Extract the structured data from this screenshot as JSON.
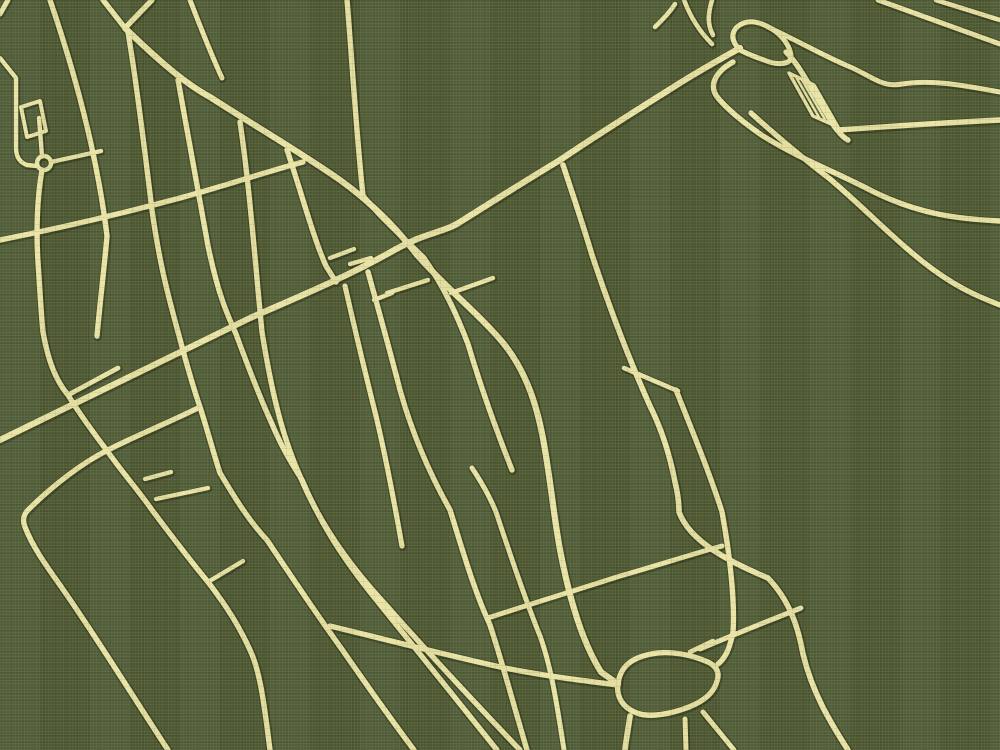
{
  "canvas": {
    "width": 1000,
    "height": 750
  },
  "style": {
    "background": "#4f5b33",
    "road_fill": "#e9e3a2",
    "road_casing": "#353f20",
    "casing_extra": 3,
    "hatch_width": 2.4
  },
  "map": {
    "kind": "minimalist-street-map-poster",
    "features": {
      "roundabout": {
        "cx": 44,
        "cy": 163,
        "r": 7
      },
      "pond_ring_road": {
        "cx": 667,
        "cy": 684
      },
      "bridge_hatch": {
        "x": 813,
        "y": 100
      },
      "interchange_loop": {
        "cx": 762,
        "cy": 43
      }
    }
  },
  "roads": [
    {
      "id": "v2-avenue",
      "w": 6.2,
      "casing": true,
      "d": "M0,440 C90,396 180,352 250,318 C300,296 345,278 398,248 C425,233 445,232 460,222 C495,200 530,178 560,160 C600,133 640,108 672,88 C700,70 726,56 740,48"
    },
    {
      "id": "v1-avenue",
      "w": 6.2,
      "casing": true,
      "d": "M125,28 C160,62 186,84 210,97 C255,126 300,152 340,180 C372,203 398,230 417,255 C448,290 480,315 504,344 C528,374 538,410 544,444 C552,490 554,520 561,555 C571,606 584,645 601,672 L618,684"
    },
    {
      "id": "v-arm-left",
      "w": 5.4,
      "casing": true,
      "d": "M103,0 L125,28"
    },
    {
      "id": "v-arm-right",
      "w": 5.4,
      "casing": true,
      "d": "M152,0 L125,28"
    },
    {
      "id": "x1-cross",
      "w": 5.4,
      "casing": true,
      "d": "M0,240 C60,228 120,214 180,198 C225,186 265,172 303,162"
    },
    {
      "id": "corner-nw",
      "w": 5.0,
      "casing": true,
      "d": "M8,0 L0,14"
    },
    {
      "id": "w2-street",
      "w": 5.4,
      "casing": true,
      "d": "M50,0 C78,82 98,162 107,236 C104,270 100,302 97,336"
    },
    {
      "id": "complex-l",
      "w": 4.4,
      "casing": true,
      "d": "M0,58 L16,78 L16,148 Q16,161 27,165 L37,166"
    },
    {
      "id": "complex-block",
      "w": 4.0,
      "casing": true,
      "d": "M21,107 L40,101 L46,131 L27,137 Z"
    },
    {
      "id": "roundabout",
      "w": 4.4,
      "casing": true,
      "d": "M37,163 a7,7 0 1 0 14,0 a7,7 0 1 0 -14,0"
    },
    {
      "id": "stub-up",
      "w": 4.4,
      "casing": true,
      "d": "M42,156 L39,118"
    },
    {
      "id": "stub-right",
      "w": 4.4,
      "casing": true,
      "d": "M51,162 L101,151"
    },
    {
      "id": "w1-street",
      "w": 5.4,
      "casing": true,
      "d": "M42,170 C37,198 36,232 38,262 C40,292 41,312 43,332 C49,366 58,383 68,395 C82,418 96,436 108,452 C122,472 138,490 152,510 C170,534 189,559 208,582 C228,608 240,628 250,650 C261,673 265,712 270,750"
    },
    {
      "id": "spur-ra",
      "w": 4.8,
      "casing": true,
      "d": "M68,395 L118,368"
    },
    {
      "id": "g3-street",
      "w": 5.4,
      "casing": true,
      "d": "M128,32 C138,92 146,162 152,210 C160,268 170,302 178,332 C186,362 194,390 200,407 C208,432 214,455 220,473 C236,500 250,522 267,540 C291,576 315,612 341,648 C366,684 390,718 414,750"
    },
    {
      "id": "ca-road",
      "w": 5.4,
      "casing": true,
      "d": "M200,407 C170,422 135,436 108,450 C80,464 50,488 28,510 C24,514 22,520 25,527 C33,548 48,568 62,588 C95,635 132,695 168,750"
    },
    {
      "id": "g4-street",
      "w": 5.4,
      "casing": true,
      "d": "M178,80 C188,136 199,194 208,246 C218,294 227,314 236,334 C250,372 260,398 272,424 C282,448 292,464 302,480 C320,522 340,554 370,592 C402,632 452,694 497,750"
    },
    {
      "id": "g5-street",
      "w": 5.4,
      "casing": true,
      "d": "M240,122 C250,190 255,262 262,332 C272,395 283,438 300,476 C318,520 346,562 386,605 C424,648 478,706 520,750"
    },
    {
      "id": "spur-t1",
      "w": 4.4,
      "casing": true,
      "d": "M145,479 L171,472"
    },
    {
      "id": "spur-t2",
      "w": 4.4,
      "casing": true,
      "d": "M156,499 L208,488"
    },
    {
      "id": "spur-w1",
      "w": 4.4,
      "casing": true,
      "d": "M208,582 L243,561"
    },
    {
      "id": "short-top",
      "w": 5.0,
      "casing": true,
      "d": "M190,0 C200,26 210,52 222,78"
    },
    {
      "id": "w8-street",
      "w": 5.4,
      "casing": true,
      "d": "M287,150 C300,188 314,240 326,266 L336,282"
    },
    {
      "id": "b-street",
      "w": 5.4,
      "casing": true,
      "d": "M347,0 C352,60 356,130 363,196"
    },
    {
      "id": "w7-street",
      "w": 5.4,
      "casing": true,
      "d": "M363,196 C385,222 408,242 424,258 C446,290 458,318 468,344 C481,388 497,432 512,470"
    },
    {
      "id": "w6-street",
      "w": 5.4,
      "casing": true,
      "d": "M368,272 C380,315 391,355 400,390 C414,440 432,478 450,510 C462,548 473,588 490,625 C504,668 515,710 527,750"
    },
    {
      "id": "g6-street",
      "w": 5.2,
      "casing": true,
      "d": "M345,286 C355,330 365,372 374,408 C382,440 390,478 402,546"
    },
    {
      "id": "rung-r3",
      "w": 4.4,
      "casing": true,
      "d": "M387,293 L428,280"
    },
    {
      "id": "rung-rb",
      "w": 4.4,
      "casing": true,
      "d": "M451,293 L493,278"
    },
    {
      "id": "rung-rd",
      "w": 4.4,
      "casing": true,
      "d": "M330,258 L354,249"
    },
    {
      "id": "rung-re",
      "w": 4.4,
      "casing": true,
      "d": "M350,264 L371,258"
    },
    {
      "id": "rung-rf",
      "w": 4.4,
      "casing": true,
      "d": "M374,300 L392,293"
    },
    {
      "id": "g9-street",
      "w": 5.6,
      "casing": true,
      "d": "M563,165 C573,195 583,225 592,255 C611,312 632,366 650,406 C662,430 670,456 675,482 C678,494 679,502 679,512 C690,542 730,562 768,578 C789,600 798,626 803,654 C812,692 830,722 848,750"
    },
    {
      "id": "g10-street",
      "w": 5.4,
      "casing": true,
      "d": "M676,390 C696,440 712,480 722,512 C730,555 735,602 733,632 C729,652 724,659 718,664"
    },
    {
      "id": "rung-rc",
      "w": 4.6,
      "casing": true,
      "d": "M624,368 L678,391"
    },
    {
      "id": "x2-avenue",
      "w": 5.4,
      "casing": true,
      "d": "M330,626 C392,641 450,656 505,668 C545,676 586,681 618,685"
    },
    {
      "id": "x3-cross",
      "w": 5.0,
      "casing": true,
      "d": "M488,618 C530,604 580,589 620,576 C656,566 692,554 722,546"
    },
    {
      "id": "x4-cross",
      "w": 5.0,
      "casing": true,
      "d": "M700,649 C735,634 768,621 801,608"
    },
    {
      "id": "pond-loop",
      "w": 5.4,
      "casing": true,
      "d": "M618,684 C620,667 631,658 651,654 C670,650 692,655 708,662 C716,666 720,672 717,681 C714,693 704,701 689,707 C671,714 649,718 637,713 C623,708 616,697 618,684 Z"
    },
    {
      "id": "pond-stub-ne",
      "w": 4.6,
      "casing": true,
      "d": "M690,652 L713,641"
    },
    {
      "id": "pond-stub-s1",
      "w": 5.0,
      "casing": true,
      "d": "M685,719 L686,750"
    },
    {
      "id": "pond-stub-s2",
      "w": 5.0,
      "casing": true,
      "d": "M703,712 C716,728 726,740 734,750"
    },
    {
      "id": "v1-south",
      "w": 5.8,
      "casing": true,
      "d": "M630,716 C628,730 626,740 625,750"
    },
    {
      "id": "g11-street",
      "w": 5.0,
      "casing": true,
      "d": "M472,468 C482,483 490,497 496,512 C510,554 524,596 540,636 C552,669 558,712 564,750"
    },
    {
      "id": "interchange-loop",
      "w": 5.0,
      "casing": true,
      "d": "M740,50 Q728,38 736,28 Q746,18 762,24 Q780,31 788,46 Q794,58 788,62 Q778,66 764,60 Q750,55 744,52 Z"
    },
    {
      "id": "bridge-road",
      "w": 5.4,
      "casing": true,
      "d": "M786,52 C794,60 799,68 804,76 L834,126 C840,134 844,138 848,140"
    },
    {
      "id": "bridge-hatch-outline",
      "w": 3.4,
      "casing": true,
      "d": "M789,73 L814,85 L838,127 L813,116 Z"
    },
    {
      "id": "bridge-hatch-lines",
      "w": 2.4,
      "casing": false,
      "d": "M796,77 L820,119 M802,80 L826,121 M808,83 L832,124"
    },
    {
      "id": "rtop-road",
      "w": 5.4,
      "casing": true,
      "d": "M838,130 C880,127 940,123 1000,120"
    },
    {
      "id": "w-road",
      "w": 5.0,
      "casing": true,
      "d": "M768,27 C800,42 824,56 848,66 C872,76 882,88 902,84 C934,79 966,86 1000,92"
    },
    {
      "id": "f1-ramp",
      "w": 5.4,
      "casing": true,
      "d": "M733,62 C715,72 708,86 718,98 C729,111 747,125 763,136 C800,159 836,172 872,191 C920,215 960,219 1000,221"
    },
    {
      "id": "f2-ramp",
      "w": 5.4,
      "casing": true,
      "d": "M751,113 C772,132 800,156 830,179 C868,211 902,248 938,273 C962,290 982,298 1000,305"
    },
    {
      "id": "corner-c1",
      "w": 5.0,
      "casing": true,
      "d": "M878,0 L1000,44"
    },
    {
      "id": "corner-c2",
      "w": 4.6,
      "casing": true,
      "d": "M936,0 L1000,20"
    },
    {
      "id": "stub-y1",
      "w": 4.6,
      "casing": true,
      "d": "M684,0 C690,16 700,32 712,44"
    },
    {
      "id": "stub-y2",
      "w": 4.6,
      "casing": true,
      "d": "M712,0 C708,14 707,24 713,35"
    },
    {
      "id": "stub-y3",
      "w": 4.6,
      "casing": true,
      "d": "M655,27 C664,18 670,12 675,4"
    }
  ]
}
